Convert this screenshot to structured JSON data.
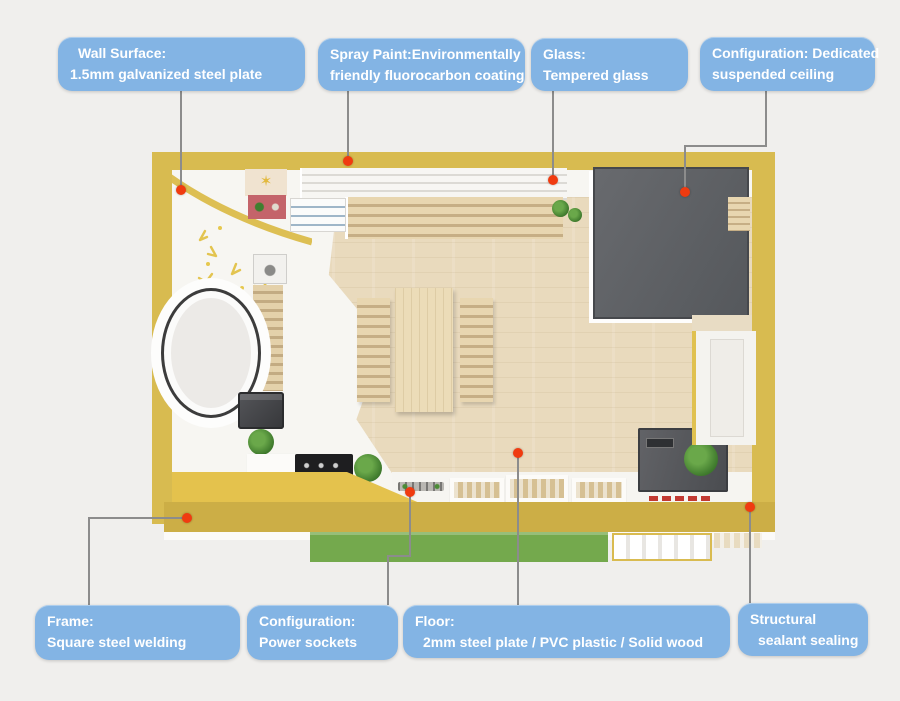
{
  "figure": {
    "type": "annotated-product-diagram",
    "subject": "container-house floor plan, top-down view"
  },
  "callouts": {
    "top": [
      {
        "id": "wall-surface",
        "line1": "Wall Surface:",
        "line2": "1.5mm galvanized steel plate"
      },
      {
        "id": "spray-paint",
        "line1": "Spray Paint:Environmentally",
        "line2": "friendly fluorocarbon coating"
      },
      {
        "id": "glass",
        "line1": "Glass:",
        "line2": "Tempered glass"
      },
      {
        "id": "ceiling",
        "line1": "Configuration: Dedicated",
        "line2": "suspended ceiling"
      }
    ],
    "bottom": [
      {
        "id": "frame",
        "line1": "Frame:",
        "line2": "Square steel welding"
      },
      {
        "id": "power",
        "line1": "Configuration:",
        "line2": "Power sockets"
      },
      {
        "id": "floor",
        "line1": "Floor:",
        "line2": "2mm steel plate / PVC plastic / Solid wood"
      },
      {
        "id": "sealant",
        "line1": "Structural",
        "line2": "sealant sealing"
      }
    ]
  },
  "colors": {
    "page_background": "#f0efed",
    "label_blue": "#83b4e4",
    "label_text": "#ffffff",
    "leader_gray": "#8c8c8c",
    "marker_red": "#f03b10",
    "wall_yellow": "#d8bb50",
    "wall_yellow_dark": "#ccae46",
    "interior_white": "#f7f6f2",
    "floor_wood": "#e9dabd",
    "suspended_ceiling_gray": "#5e6165",
    "deck_green": "#74a94d"
  }
}
